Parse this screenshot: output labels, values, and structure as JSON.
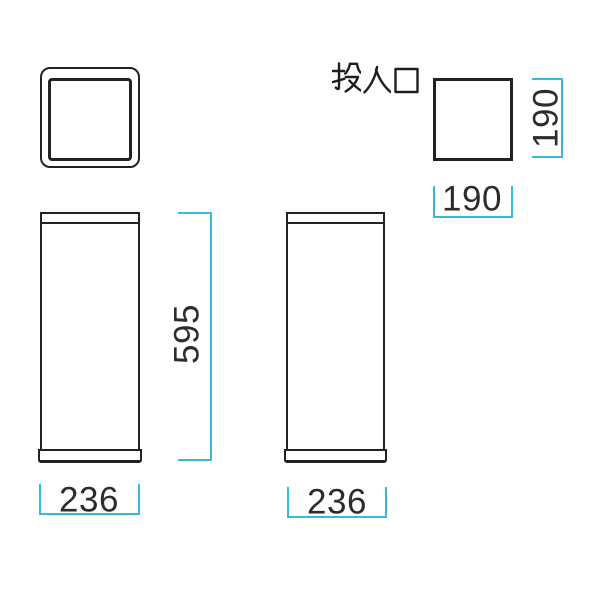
{
  "colors": {
    "outline": "#222222",
    "dimension_line": "#3ab8d9",
    "dimension_text": "#2c2c2c",
    "label_text": "#1e1e1e",
    "background": "#ffffff"
  },
  "label": {
    "insertion_opening": "投入口"
  },
  "dimensions": {
    "slot_height": "190",
    "slot_width": "190",
    "overall_height": "595",
    "front_width": "236",
    "side_width": "236"
  }
}
